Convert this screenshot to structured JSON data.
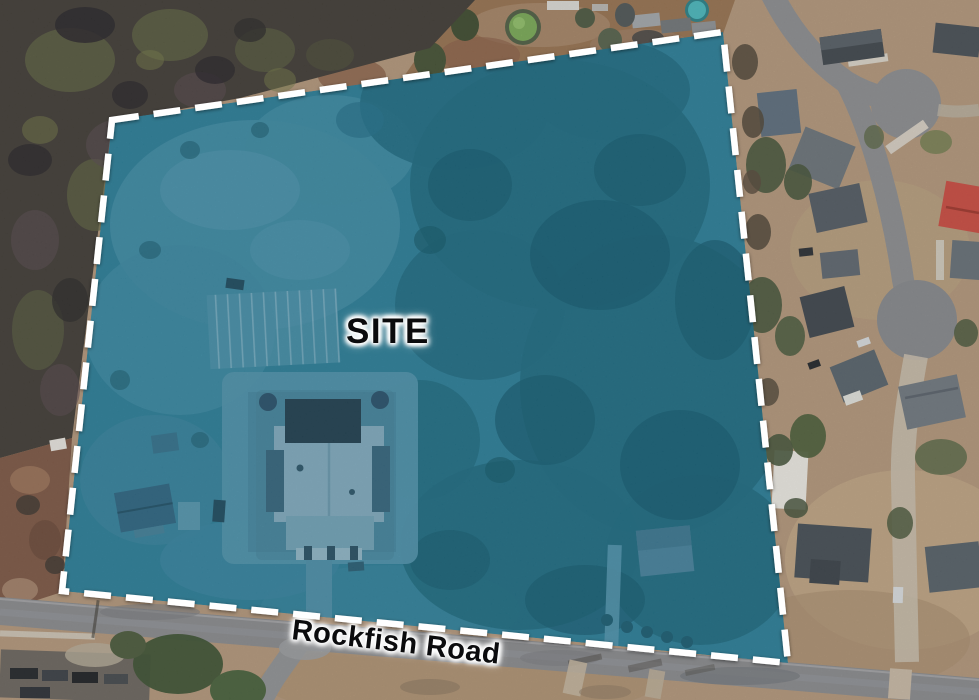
{
  "meta": {
    "kind": "aerial-satellite-site-exhibit",
    "canvas": {
      "width": 979,
      "height": 700
    }
  },
  "labels": {
    "site": "SITE",
    "road": "Rockfish Road"
  },
  "site_boundary": {
    "points": "112,120 723,32 788,663 62,591",
    "border_color": "#ffffff",
    "border_style": "dashed",
    "overlay_fill": "#2b7d97",
    "overlay_opacity": "0.95"
  },
  "palette": {
    "site_overlay_teal": "#2b7d97",
    "site_trees_teal": "#1d6a80",
    "site_field_teal": "#3f8ba4",
    "boundary_white": "#ffffff",
    "forest_dark": "#403c35",
    "dirt_tan": "#b1967a",
    "asphalt_gray": "#88898c",
    "red_roof": "#c84b40"
  }
}
